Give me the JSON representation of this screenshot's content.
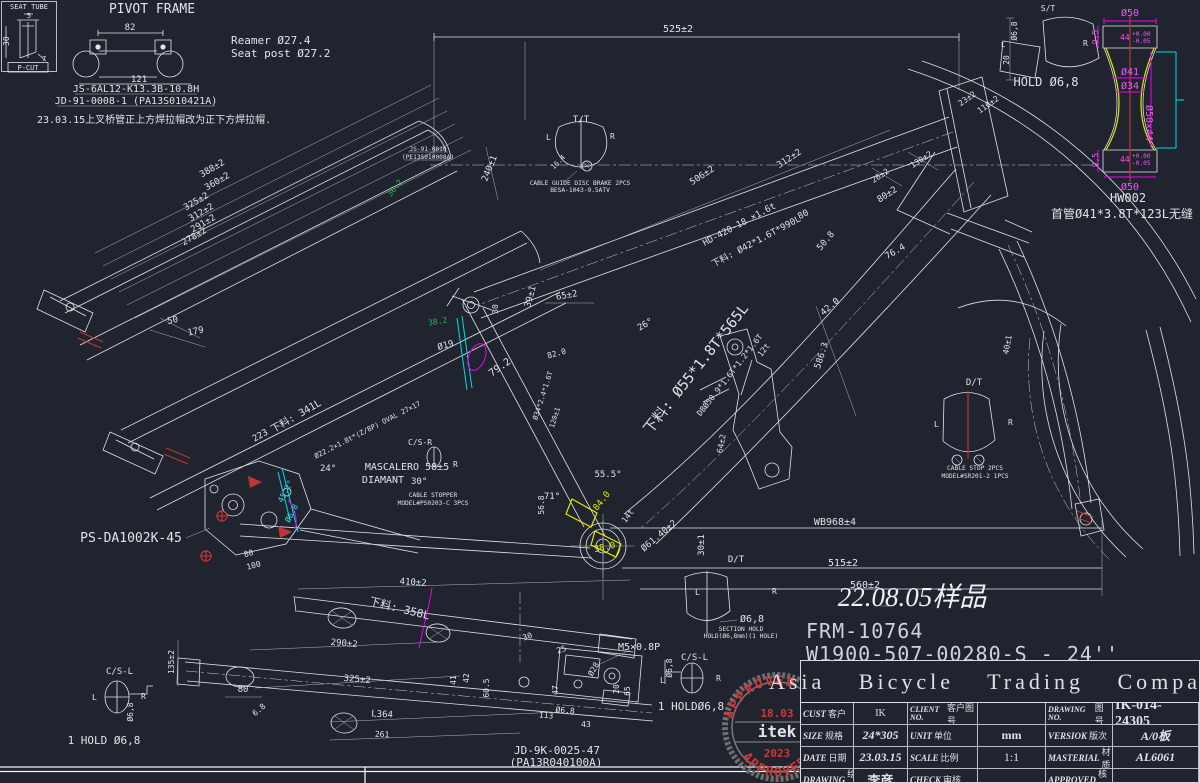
{
  "colors": {
    "background": "#20242e",
    "line": "#dfe3ea",
    "magenta": "#f000f0",
    "cyan": "#00dbe8",
    "yellow": "#e8e800",
    "red": "#c03434",
    "green": "#18c24a",
    "stamp_red": "#d43535"
  },
  "tl": {
    "box_title": "SEAT TUBE",
    "pcut": "P-CUT",
    "d30": "30",
    "d5": "5",
    "d7": "7",
    "pivot_title": "PIVOT FRAME",
    "d82": "82",
    "d121": "121",
    "part1": "JS-6AL12-K13.3B-10.8H",
    "part2": "JD-91-0008-1 (PA13S010421A)",
    "note": "23.03.15上叉桥管正上方焊拉帽改为正下方焊拉帽.",
    "reamer": "Reamer Ø27.4",
    "seatpost": "Seat post Ø27.2"
  },
  "top": {
    "d525": "525±2",
    "tt": "T/T",
    "l": "L",
    "r": "R",
    "d164": "16.4",
    "cg1": "CABLE GUIDE DISC BRAKE 2PCS",
    "cg2": "BESA-1043-9.5ATV",
    "d240": "240±1",
    "d506": "506±2",
    "d312": "312±2",
    "js91": "JS-91-0010",
    "js91b": "(PE13S010008A)",
    "g362": "36.2",
    "spec1": "HD-420-18 ×1.6t",
    "spec2": "下料: Ø42*1.6T*990L",
    "d80": "80",
    "d508": "50.8",
    "d80b": "80±2",
    "d764": "76.4",
    "d26": "26±2",
    "d130": "130±2"
  },
  "stack": {
    "a": "388±2",
    "b": "360±2",
    "c": "325±2",
    "d": "312±2",
    "e": "291±2",
    "f": "278±2",
    "d50": "50",
    "d179": "179",
    "d223": "223"
  },
  "stay": {
    "blank341": "下料: 341L",
    "spec": "Ø22.2×1.8t*(Z/8P) OVAL 27×17",
    "spec2": "Ø22.2×1.8t*(2/8P) OVAL 27.4",
    "deg24": "24°",
    "masc": "MASCALERO 58±5",
    "diamant": "DIAMANT",
    "deg30": "30°",
    "csr": "C/S-R",
    "r": "R",
    "cs1": "CABLE STOPPER",
    "cs2": "MODEL#PS0203-C 3PCS",
    "c452": "45.2°",
    "c68": "Ø6.8",
    "psda": "PS-DA1002K-45",
    "d80": "80",
    "d100": "100"
  },
  "mid": {
    "d65": "65±2",
    "d39": "39±1",
    "d30": "30",
    "d19": "Ø19",
    "d792": "79.2",
    "d820": "82.0",
    "stspec": "Ø34*2.4*1.6T",
    "d120": "120±1",
    "g382": "38.2",
    "dt1": "下料: Ø55*1.8T*565L",
    "dt2": "DBØ50.9*1.6T*1.2*1.6T",
    "t12": "12t",
    "d64": "64±2",
    "deg26": "26°",
    "d586": "586.3",
    "d420": "42.0",
    "deg555": "55.5°",
    "deg71": "71°",
    "y840": "84.0",
    "y380": "38.0",
    "t14": "14t",
    "d6140": "Ø61.40±2",
    "d568": "56.8",
    "d301": "30±1"
  },
  "wheel": {
    "wb": "WB968±4",
    "d515": "515±2",
    "d560": "560±2",
    "d401": "40±1"
  },
  "dt": {
    "label": "D/T",
    "l": "L",
    "r": "R",
    "d68": "Ø6,8",
    "sh1": "SECTION HOLD",
    "sh2": "HOLD(Ø6,8mm)(1 HOLE)"
  },
  "dtr": {
    "label": "D/T",
    "l": "L",
    "r": "R",
    "cs1": "CABLE STOP 2PCS",
    "cs2": "MODEL#SR201-2 1PCS"
  },
  "st": {
    "label": "S/T",
    "d68": "Ø6,8",
    "d20": "20",
    "l": "L",
    "hold": "HOLD Ø6,8",
    "d23": "23±2",
    "d110": "110±2"
  },
  "ids": {
    "sample": "22.08.05样品",
    "frm": "FRM-10764",
    "w": "W1900-507-00280-S - 24''"
  },
  "bottom": {
    "d410": "410±2",
    "blank358": "下料: 358L",
    "d290": "290±2",
    "d325": "325±2",
    "l364": "L364",
    "d261": "261",
    "d80": "80",
    "d68": "6.8",
    "d135": "135±2",
    "csl": "C/S-L",
    "l": "L",
    "r": "R",
    "dia68": "Ø6,8",
    "hold1": "1 HOLD Ø6,8",
    "m5": "M5×0.8P",
    "cslr": "C/S-L",
    "lr_l": "L",
    "lr_r": "R",
    "dia68r": "Ø6,8",
    "hold1r": "1 HOLDØ6,8",
    "jd": "JD-9K-0025-47",
    "jdb": "(PA13R040100A)",
    "d30": "30",
    "d25": "25",
    "d605": "60.5",
    "d42": "42",
    "d41": "41",
    "d47": "47",
    "d113": "113",
    "d68c": "Ø6.8",
    "d43": "43",
    "d28": "Ø28",
    "d20": "20",
    "d65": "65"
  },
  "hw": {
    "d50t": "Ø50",
    "d95t": "9,5",
    "d44t": "44",
    "tolp": "+0.00",
    "tolm": "-0.05",
    "r": "R",
    "d41": "Ø41",
    "d34": "Ø34",
    "d50x44": "Ø50×44",
    "d95b": "9,5",
    "d44b": "44",
    "d50b": "Ø50",
    "name": "HW002",
    "spec": "首管Ø41*3.8T*123L无缝"
  },
  "stamp": {
    "top": "APPROVED",
    "date": "18.03",
    "name": "itek",
    "year": "2023",
    "bottom": "APPROVED"
  },
  "title_block": {
    "company": "Asia Bicycle Trading Company",
    "rows": [
      {
        "k1": "CUST",
        "c1": "客户",
        "v1": "IK",
        "k2": "CLIENT NO.",
        "c2": "客户图号",
        "v2": "",
        "k3": "DRAWING NO.",
        "c3": "图号",
        "v3": "IK-014-24305"
      },
      {
        "k1": "SIZE",
        "c1": "规格",
        "v1": "24*305",
        "k2": "UNIT",
        "c2": "单位",
        "v2": "mm",
        "k3": "VERSIOK",
        "c3": "版次",
        "v3": "A/0板"
      },
      {
        "k1": "DATE",
        "c1": "日期",
        "v1": "23.03.15",
        "k2": "SCALE",
        "c2": "比例",
        "v2": "1:1",
        "k3": "MASTERIAL",
        "c3": "材质",
        "v3": "AL6061"
      },
      {
        "k1": "DRAWING",
        "c1": "绘图",
        "v1": "李彦",
        "k2": "CHECK",
        "c2": "审核",
        "v2": "",
        "k3": "APPROVED",
        "c3": "核准",
        "v3": ""
      }
    ]
  }
}
